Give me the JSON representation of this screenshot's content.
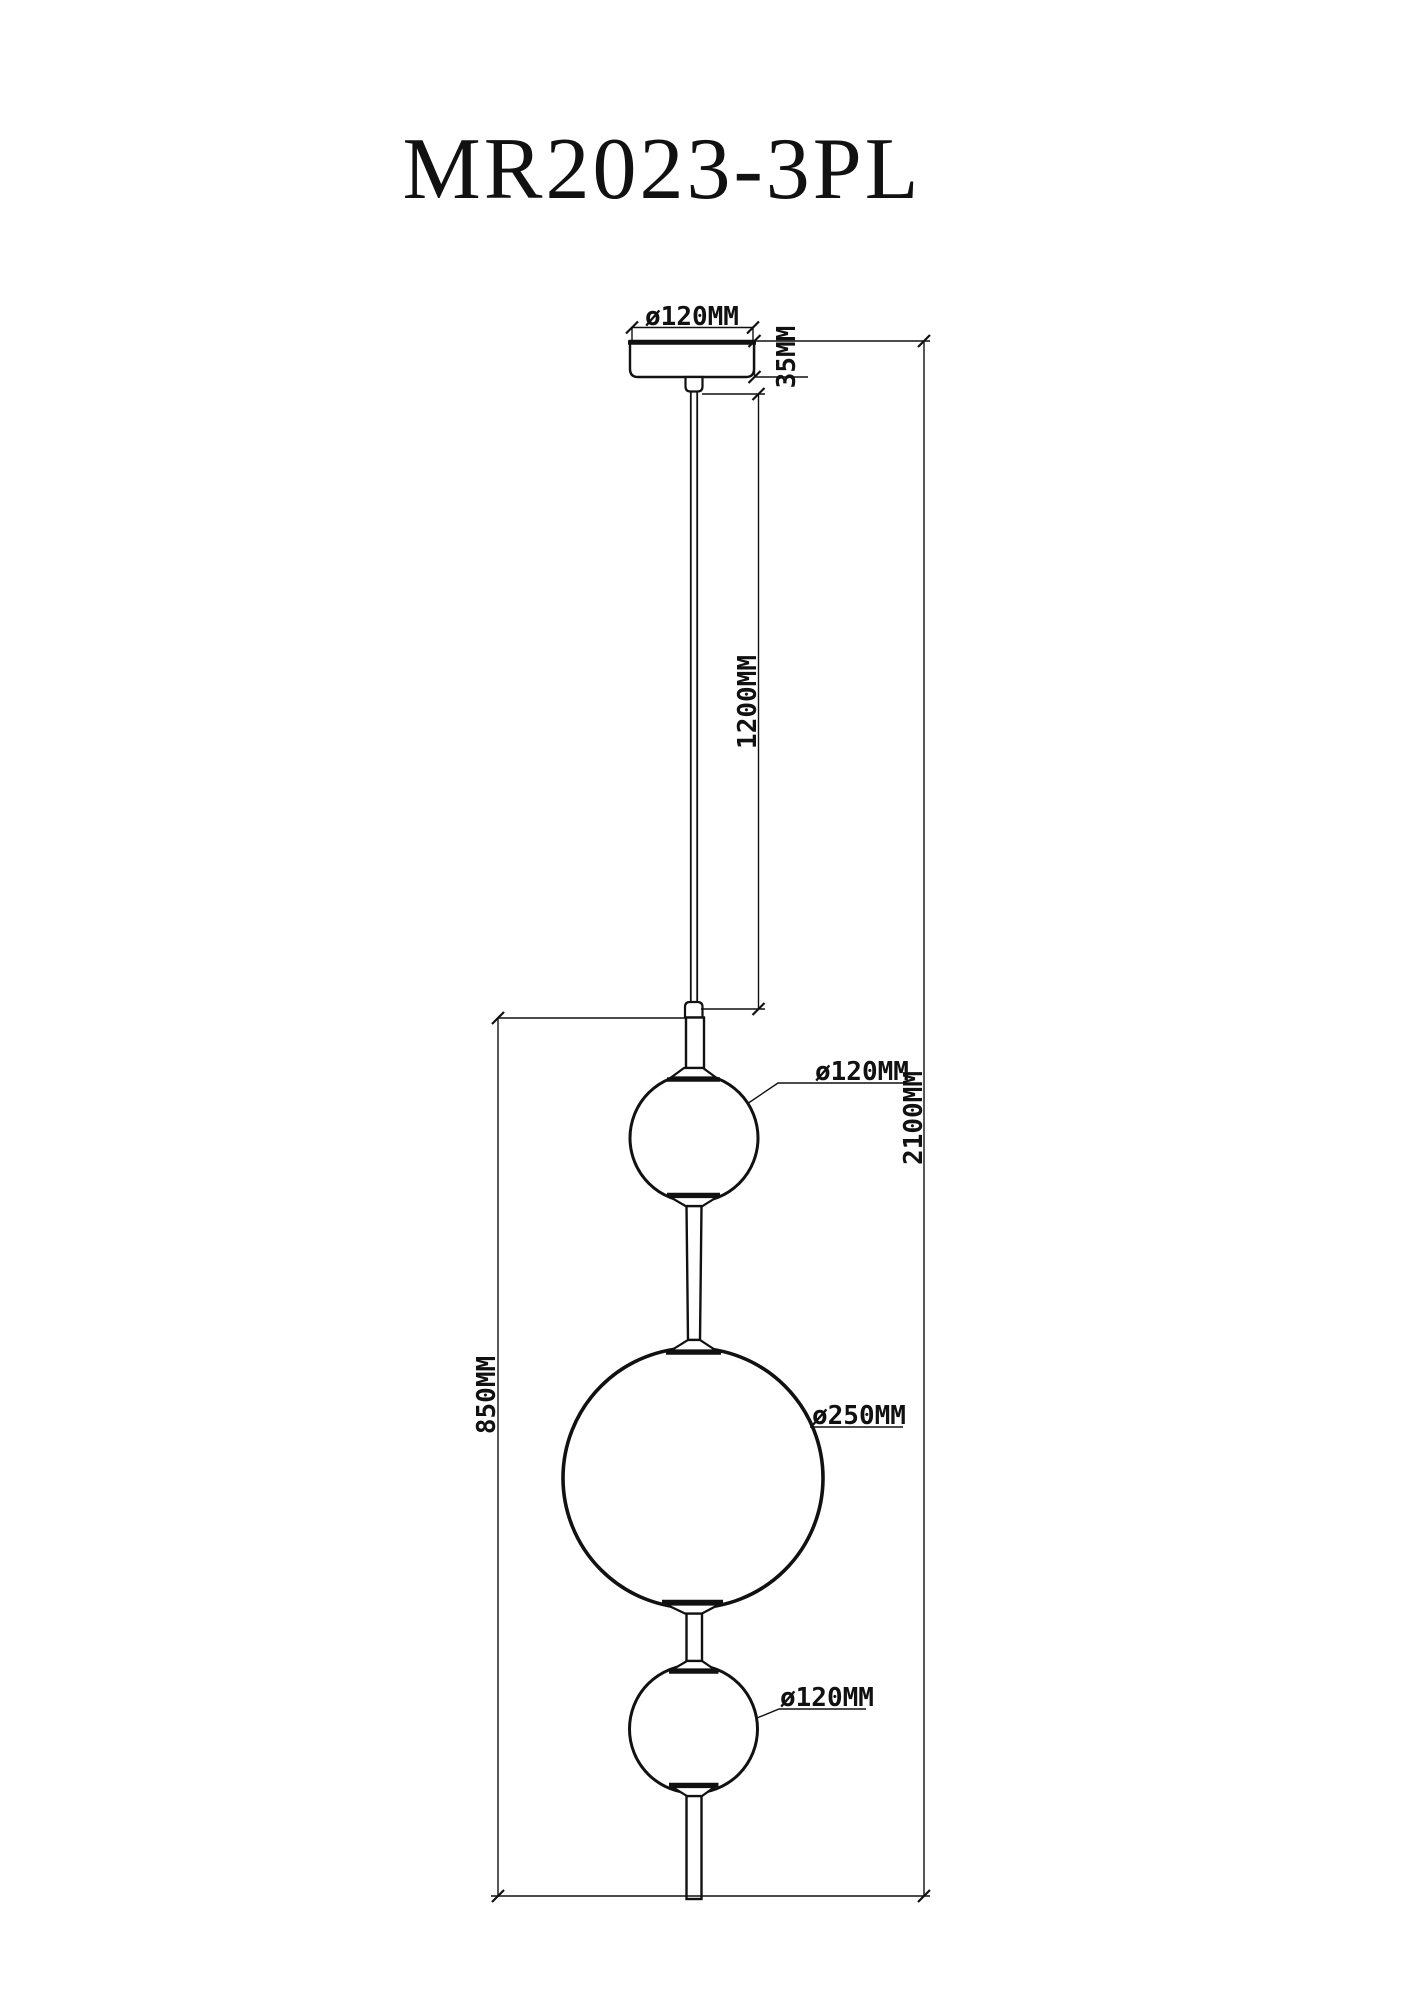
{
  "title": "MR2023-3PL",
  "dimensions": {
    "canopy_diameter": "ø120MM",
    "canopy_height": "35MM",
    "cable_length": "1200MM",
    "overall_height": "2100MM",
    "fixture_height": "850MM",
    "upper_globe_diameter": "ø120MM",
    "middle_globe_diameter": "ø250MM",
    "lower_globe_diameter": "ø120MM"
  },
  "colors": {
    "line": "#111111",
    "background": "#ffffff"
  }
}
